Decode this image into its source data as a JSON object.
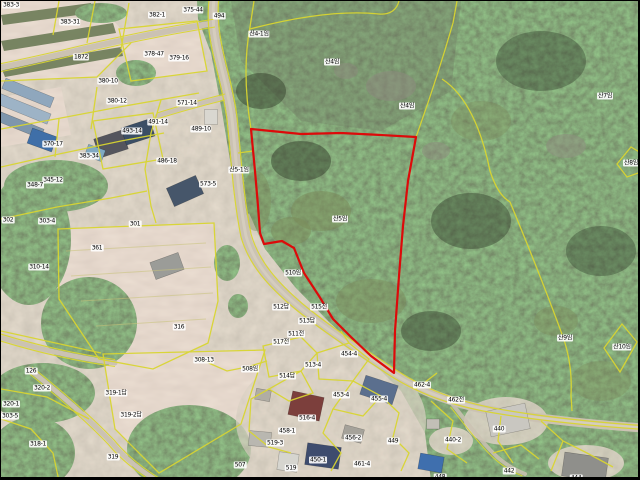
{
  "map": {
    "type": "cadastral-aerial-map",
    "width": 640,
    "height": 480,
    "colors": {
      "parcel_line": "#d9d531",
      "hedge_line": "#c9c37a",
      "highlight_line": "#dd0a0a",
      "road": "#cbc2b3",
      "label_bg": "rgba(255,255,255,0.9)",
      "label_text": "#000000"
    },
    "highlighted_parcel": {
      "label": "산5임",
      "boundary_color": "#dd0a0a"
    },
    "parcel_labels": [
      {
        "text": "383-3",
        "x": 10,
        "y": 4
      },
      {
        "text": "383-31",
        "x": 69,
        "y": 21
      },
      {
        "text": "1872",
        "x": 80,
        "y": 56
      },
      {
        "text": "382-1",
        "x": 156,
        "y": 14
      },
      {
        "text": "375-44",
        "x": 192,
        "y": 9
      },
      {
        "text": "494",
        "x": 218,
        "y": 15
      },
      {
        "text": "378-47",
        "x": 153,
        "y": 53
      },
      {
        "text": "379-16",
        "x": 178,
        "y": 57
      },
      {
        "text": "380-10",
        "x": 107,
        "y": 80
      },
      {
        "text": "380-12",
        "x": 116,
        "y": 100
      },
      {
        "text": "571-14",
        "x": 186,
        "y": 102
      },
      {
        "text": "491-14",
        "x": 157,
        "y": 121
      },
      {
        "text": "489-10",
        "x": 200,
        "y": 128
      },
      {
        "text": "493-14",
        "x": 131,
        "y": 130
      },
      {
        "text": "370-17",
        "x": 52,
        "y": 143
      },
      {
        "text": "383-34",
        "x": 88,
        "y": 155
      },
      {
        "text": "486-18",
        "x": 166,
        "y": 160
      },
      {
        "text": "345-12",
        "x": 52,
        "y": 179
      },
      {
        "text": "348-7",
        "x": 34,
        "y": 184
      },
      {
        "text": "573-5",
        "x": 207,
        "y": 183
      },
      {
        "text": "302",
        "x": 7,
        "y": 219
      },
      {
        "text": "303-4",
        "x": 46,
        "y": 220
      },
      {
        "text": "301",
        "x": 134,
        "y": 223
      },
      {
        "text": "361",
        "x": 96,
        "y": 247
      },
      {
        "text": "310-14",
        "x": 38,
        "y": 266
      },
      {
        "text": "316",
        "x": 178,
        "y": 326
      },
      {
        "text": "308-13",
        "x": 203,
        "y": 359
      },
      {
        "text": "126",
        "x": 30,
        "y": 370
      },
      {
        "text": "508임",
        "x": 249,
        "y": 368
      },
      {
        "text": "320-2",
        "x": 41,
        "y": 387
      },
      {
        "text": "319-1답",
        "x": 115,
        "y": 392
      },
      {
        "text": "320-1",
        "x": 10,
        "y": 403
      },
      {
        "text": "303-5",
        "x": 9,
        "y": 415
      },
      {
        "text": "319-2답",
        "x": 130,
        "y": 414
      },
      {
        "text": "318-1",
        "x": 37,
        "y": 443
      },
      {
        "text": "319",
        "x": 112,
        "y": 456
      },
      {
        "text": "507",
        "x": 239,
        "y": 464
      },
      {
        "text": "산4-1임",
        "x": 258,
        "y": 33
      },
      {
        "text": "산4임",
        "x": 331,
        "y": 61
      },
      {
        "text": "산4임",
        "x": 406,
        "y": 105
      },
      {
        "text": "산5-1임",
        "x": 238,
        "y": 169
      },
      {
        "text": "산5임",
        "x": 339,
        "y": 218
      },
      {
        "text": "산7임",
        "x": 604,
        "y": 95
      },
      {
        "text": "산8임",
        "x": 630,
        "y": 162
      },
      {
        "text": "산9임",
        "x": 564,
        "y": 337
      },
      {
        "text": "산10임",
        "x": 621,
        "y": 346
      },
      {
        "text": "510임",
        "x": 292,
        "y": 272
      },
      {
        "text": "512답",
        "x": 280,
        "y": 306
      },
      {
        "text": "515전",
        "x": 318,
        "y": 306
      },
      {
        "text": "513답",
        "x": 306,
        "y": 320
      },
      {
        "text": "511전",
        "x": 295,
        "y": 333
      },
      {
        "text": "517전",
        "x": 280,
        "y": 341
      },
      {
        "text": "454-4",
        "x": 348,
        "y": 353
      },
      {
        "text": "513-4",
        "x": 312,
        "y": 364
      },
      {
        "text": "514답",
        "x": 286,
        "y": 375
      },
      {
        "text": "462-4",
        "x": 421,
        "y": 384
      },
      {
        "text": "453-4",
        "x": 340,
        "y": 394
      },
      {
        "text": "455-4",
        "x": 378,
        "y": 398
      },
      {
        "text": "462전",
        "x": 455,
        "y": 399
      },
      {
        "text": "516-4",
        "x": 306,
        "y": 417
      },
      {
        "text": "458-1",
        "x": 286,
        "y": 430
      },
      {
        "text": "440",
        "x": 498,
        "y": 428
      },
      {
        "text": "456-2",
        "x": 352,
        "y": 437
      },
      {
        "text": "519-3",
        "x": 274,
        "y": 442
      },
      {
        "text": "440-2",
        "x": 452,
        "y": 439
      },
      {
        "text": "449",
        "x": 392,
        "y": 440
      },
      {
        "text": "450-1",
        "x": 317,
        "y": 459
      },
      {
        "text": "461-4",
        "x": 361,
        "y": 463
      },
      {
        "text": "519",
        "x": 290,
        "y": 467
      },
      {
        "text": "448",
        "x": 439,
        "y": 476
      },
      {
        "text": "442",
        "x": 508,
        "y": 470
      },
      {
        "text": "444",
        "x": 575,
        "y": 477
      }
    ]
  }
}
